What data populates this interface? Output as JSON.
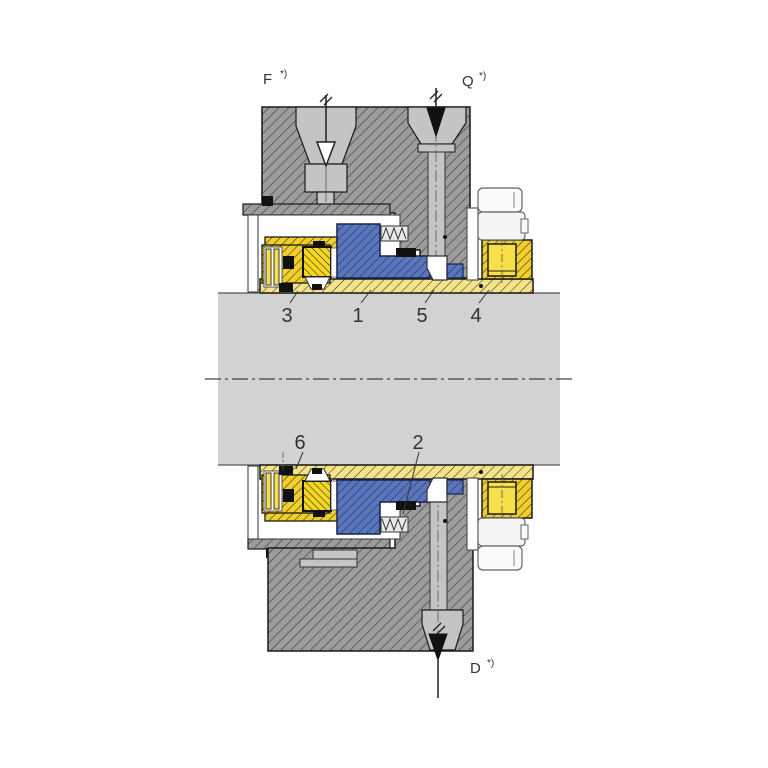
{
  "diagram": {
    "type": "mechanical seal cross-section",
    "ports": {
      "f": {
        "label": "F",
        "sup": "*)"
      },
      "q": {
        "label": "Q",
        "sup": "*)"
      },
      "d": {
        "label": "D",
        "sup": "*)"
      }
    },
    "callouts": [
      {
        "label": "3"
      },
      {
        "label": "1"
      },
      {
        "label": "5"
      },
      {
        "label": "4"
      },
      {
        "label": "6"
      },
      {
        "label": "2"
      }
    ],
    "colors": {
      "housing_gray": "#9c9c9c",
      "channel_gray": "#c4c4c4",
      "shaft_gray": "#d2d2d2",
      "sleeve_yellow": "#f5e38a",
      "gland_yellow": "#f0cf2d",
      "seat_yellow": "#f6d71f",
      "face_blue": "#5a76ba",
      "background": "#ffffff"
    }
  }
}
